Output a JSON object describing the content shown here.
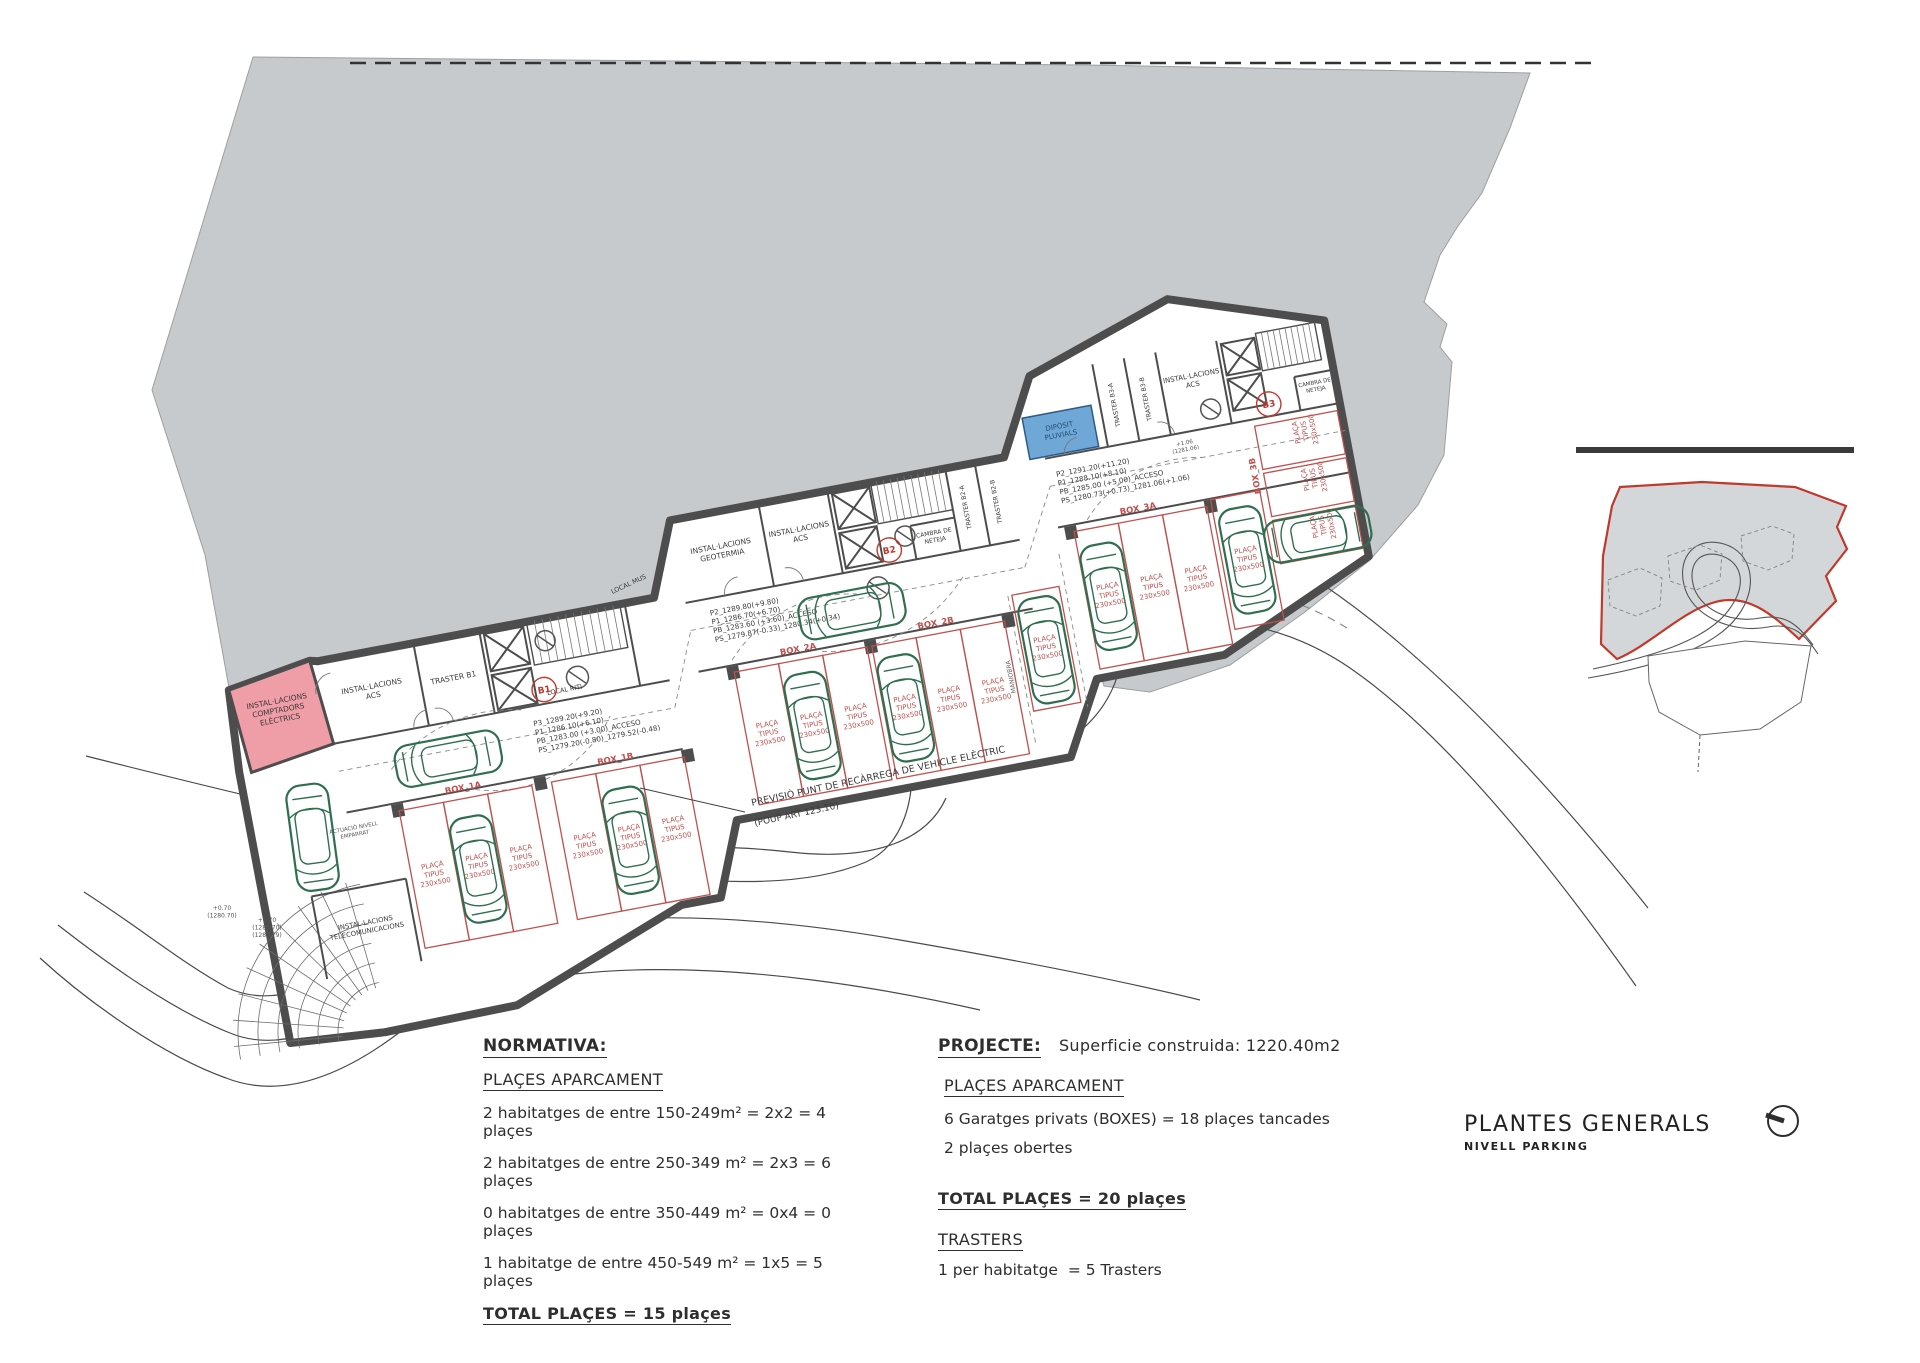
{
  "colors": {
    "terrain": "#c7cacc",
    "wall": "#4d4d4d",
    "red": "#c0504d",
    "boundary_red": "#c0392b",
    "car_green": "#2f6f4f",
    "pink": "#ef9da6",
    "blue": "#6fa8d6",
    "ink": "#3a3a3a"
  },
  "titleblock": {
    "title": "PLANTES GENERALS",
    "subtitle": "NIVELL PARKING",
    "north_icon": "north-arrow-circle"
  },
  "normativa": {
    "heading": "NORMATIVA:",
    "subheading": "PLAÇES APARCAMENT",
    "lines": [
      "2 habitatges de entre 150-249m² = 2x2 = 4 plaçes",
      "2 habitatges de entre 250-349 m² = 2x3 = 6 plaçes",
      "0 habitatges de entre 350-449 m² = 0x4 = 0 plaçes",
      "1 habitatge de entre 450-549 m² = 1x5 = 5 plaçes"
    ],
    "total": "TOTAL PLAÇES = 15 plaçes"
  },
  "projecte": {
    "heading": "PROJECTE:",
    "superficie": "Superficie construida: 1220.40m2",
    "subheading": "PLAÇES APARCAMENT",
    "lines": [
      "6 Garatges privats (BOXES) = 18 plaçes tancades",
      "2 plaçes obertes"
    ],
    "total": "TOTAL PLAÇES = 20 plaçes",
    "trasters_heading": "TRASTERS",
    "trasters_line": "1 per habitatge  = 5 Trasters"
  },
  "plan": {
    "stall_text": [
      "PLAÇA",
      "TIPUS",
      "230x500"
    ],
    "labels": [
      {
        "lines": [
          "INSTAL·LACIONS",
          "COMPTADORS",
          "ELÈCTRICS"
        ],
        "x": 300,
        "y": 562,
        "size": 7.5,
        "name": "room-label-comptadors"
      },
      {
        "lines": [
          "INSTAL·LACIONS",
          "ACS"
        ],
        "x": 396,
        "y": 565,
        "size": 7.5,
        "name": "room-label-acs-1"
      },
      {
        "lines": [
          "TRASTER B1"
        ],
        "x": 478,
        "y": 572,
        "size": 7.5,
        "name": "room-label-traster-b1"
      },
      {
        "lines": [
          "LOCAL RITI"
        ],
        "x": 585,
        "y": 604,
        "size": 6.5,
        "name": "room-label-local-riti"
      },
      {
        "lines": [
          "LOCAL MUS"
        ],
        "x": 668,
        "y": 512,
        "size": 6.5,
        "rot": -14,
        "name": "room-label-local-mus"
      },
      {
        "lines": [
          "INSTAL·LACIONS",
          "GEOTERMIA"
        ],
        "x": 765,
        "y": 492,
        "size": 7.5,
        "name": "room-label-geotermia"
      },
      {
        "lines": [
          "INSTAL·LACIONS",
          "ACS"
        ],
        "x": 845,
        "y": 490,
        "size": 7.5,
        "name": "room-label-acs-2"
      },
      {
        "lines": [
          "CAMBRA DE",
          "NETEJA"
        ],
        "x": 977,
        "y": 518,
        "size": 6,
        "name": "room-label-cambra-neteja-1"
      },
      {
        "lines": [
          "TRASTER B2-A"
        ],
        "x": 1015,
        "y": 497,
        "size": 6.2,
        "rot": -90,
        "name": "room-label-traster-b2a"
      },
      {
        "lines": [
          "TRASTER B2-B"
        ],
        "x": 1046,
        "y": 497,
        "size": 6.2,
        "rot": -90,
        "name": "room-label-traster-b2b"
      },
      {
        "lines": [
          "DIPÒSIT",
          "PLUVIALS"
        ],
        "x": 1120,
        "y": 437,
        "size": 7,
        "color": "#234e75",
        "name": "room-label-diposit-pluvials"
      },
      {
        "lines": [
          "TRASTER B3-A"
        ],
        "x": 1180,
        "y": 424,
        "size": 6.2,
        "rot": -90,
        "name": "room-label-traster-b3a"
      },
      {
        "lines": [
          "TRASTER B3-B"
        ],
        "x": 1212,
        "y": 424,
        "size": 6.2,
        "rot": -90,
        "name": "room-label-traster-b3b"
      },
      {
        "lines": [
          "INSTAL·LACIONS",
          "ACS"
        ],
        "x": 1259,
        "y": 412,
        "size": 7,
        "name": "room-label-acs-3"
      },
      {
        "lines": [
          "CAMBRA DE",
          "NETEJA"
        ],
        "x": 1379,
        "y": 441,
        "size": 5.5,
        "name": "room-label-cambra-neteja-2"
      },
      {
        "lines": [
          "MANIOBRA"
        ],
        "x": 1028,
        "y": 672,
        "size": 6.2,
        "rot": -90,
        "color": "#666666",
        "name": "zone-label-maniobra"
      },
      {
        "lines": [
          "INSTAL·LACIONS",
          "TELECOMUNICACIONS"
        ],
        "x": 346,
        "y": 796,
        "size": 6.8,
        "name": "room-label-telecomunicacions"
      },
      {
        "lines": [
          "ACTUACIÓ NIVELL",
          "EMPARRAT"
        ],
        "x": 352,
        "y": 700,
        "size": 5.5,
        "color": "#555555",
        "name": "note-actuacio"
      },
      {
        "lines": [
          "B1"
        ],
        "x": 565,
        "y": 601,
        "size": 9,
        "bold": true,
        "color": "#c0392b",
        "circ": true,
        "name": "core-marker-b1"
      },
      {
        "lines": [
          "B2"
        ],
        "x": 930,
        "y": 528,
        "size": 9,
        "bold": true,
        "color": "#c0392b",
        "circ": true,
        "name": "core-marker-b2"
      },
      {
        "lines": [
          "B3"
        ],
        "x": 1330,
        "y": 455,
        "size": 9,
        "bold": true,
        "color": "#c0392b",
        "circ": true,
        "name": "core-marker-b3"
      },
      {
        "lines": [
          "+1.06",
          "(1281.06)"
        ],
        "x": 1240,
        "y": 476,
        "size": 5.5,
        "color": "#555555",
        "name": "spot-level-1"
      },
      {
        "lines": [
          "PREVISIÓ PUNT DE RECÀRREGA DE VEHICLE ELÈCTRIC"
        ],
        "x": 752,
        "y": 806,
        "size": 9.5,
        "rot": -12,
        "anchor": "start",
        "layer": "page",
        "name": "annotation-ev-charging"
      },
      {
        "lines": [
          "(POUP ART 123.10)"
        ],
        "x": 755,
        "y": 826,
        "size": 9,
        "rot": -12,
        "anchor": "start",
        "layer": "page",
        "name": "annotation-ev-charging-ref"
      },
      {
        "lines": [
          "+0.70",
          "(1280.70)"
        ],
        "x": 222,
        "y": 910,
        "size": 6,
        "layer": "page",
        "color": "#555555",
        "name": "spot-level-entrance-1"
      },
      {
        "lines": [
          "+0.70",
          "(1280.70)",
          "(1280.79)"
        ],
        "x": 267,
        "y": 922,
        "size": 6,
        "layer": "page",
        "color": "#555555",
        "name": "spot-level-entrance-2"
      }
    ],
    "level_groups": [
      {
        "x": 548,
        "y": 632,
        "lines": [
          "P3_1289.20(+9.20)",
          "P1_1286.10(+6.10)",
          "PB_1283.00 (+3.00)_ACCESO",
          "PS_1279.20(-0.80)_1279.52(-0.48)"
        ]
      },
      {
        "x": 742,
        "y": 556,
        "lines": [
          "P2_1289.80(+9.80)",
          "P1_1286.70(+6.70)",
          "PB_1283.60 (+3.60)_ACCESO",
          "PS_1279.87(-0.33)_1280.34(+0.34)"
        ]
      },
      {
        "x": 1108,
        "y": 484,
        "lines": [
          "P2_1291.20(+11.20)",
          "P1_1288.10(+8.10)",
          "PB_1285.00 (+5.00)_ACCESO",
          "PS_1280.73(+0.73)_1281.06(+1.06)"
        ]
      }
    ],
    "boxes": [
      {
        "t": "BOX_1A",
        "x": 467,
        "y": 682
      },
      {
        "t": "BOX_1B",
        "x": 622,
        "y": 682
      },
      {
        "t": "BOX_2A",
        "x": 822,
        "y": 608
      },
      {
        "t": "BOX_2B",
        "x": 962,
        "y": 608
      },
      {
        "t": "BOX_3A",
        "x": 1182,
        "y": 533
      },
      {
        "t": "BOX_3B",
        "x": 1306,
        "y": 520,
        "rot": -90
      }
    ],
    "stalls": [
      {
        "x": 400,
        "y": 690,
        "w": 45,
        "h": 140
      },
      {
        "x": 445,
        "y": 690,
        "w": 45,
        "h": 140
      },
      {
        "x": 490,
        "y": 690,
        "w": 45,
        "h": 140
      },
      {
        "x": 555,
        "y": 690,
        "w": 45,
        "h": 140
      },
      {
        "x": 600,
        "y": 690,
        "w": 45,
        "h": 140
      },
      {
        "x": 645,
        "y": 690,
        "w": 45,
        "h": 140
      },
      {
        "x": 755,
        "y": 616,
        "w": 45,
        "h": 135
      },
      {
        "x": 800,
        "y": 616,
        "w": 45,
        "h": 135
      },
      {
        "x": 845,
        "y": 616,
        "w": 45,
        "h": 135
      },
      {
        "x": 895,
        "y": 616,
        "w": 45,
        "h": 135
      },
      {
        "x": 940,
        "y": 616,
        "w": 45,
        "h": 135
      },
      {
        "x": 985,
        "y": 616,
        "w": 45,
        "h": 135
      },
      {
        "x": 1042,
        "y": 592,
        "w": 48,
        "h": 118
      },
      {
        "x": 1115,
        "y": 541,
        "w": 45,
        "h": 140
      },
      {
        "x": 1160,
        "y": 541,
        "w": 45,
        "h": 140
      },
      {
        "x": 1205,
        "y": 541,
        "w": 45,
        "h": 140
      },
      {
        "x": 1255,
        "y": 535,
        "w": 50,
        "h": 132
      },
      {
        "x": 1312,
        "y": 471,
        "w": 84,
        "h": 44,
        "vert": true
      },
      {
        "x": 1312,
        "y": 519,
        "w": 84,
        "h": 44,
        "vert": true
      },
      {
        "x": 1312,
        "y": 567,
        "w": 84,
        "h": 44,
        "vert": true
      }
    ],
    "cars": [
      {
        "x": 310,
        "y": 700,
        "rot": 3
      },
      {
        "x": 458,
        "y": 648,
        "rot": 90
      },
      {
        "x": 882,
        "y": 578,
        "rot": 90
      },
      {
        "x": 467,
        "y": 762,
        "rot": 0
      },
      {
        "x": 622,
        "y": 762,
        "rot": 0
      },
      {
        "x": 822,
        "y": 683,
        "rot": 0
      },
      {
        "x": 917,
        "y": 683,
        "rot": 0
      },
      {
        "x": 1066,
        "y": 652,
        "rot": 0
      },
      {
        "x": 1137,
        "y": 611,
        "rot": 0
      },
      {
        "x": 1280,
        "y": 601,
        "rot": 0
      },
      {
        "x": 1354,
        "y": 589,
        "rot": 90
      }
    ]
  }
}
